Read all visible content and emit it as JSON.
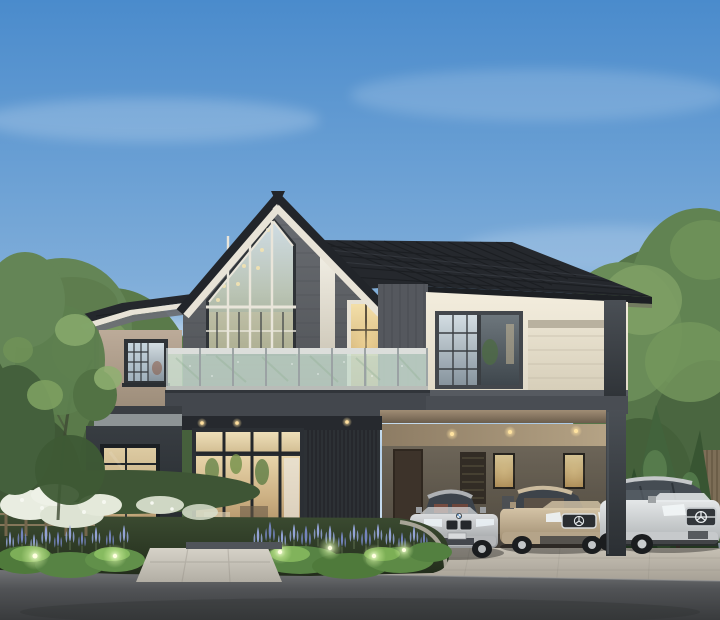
{
  "scene": {
    "description": "Dusk architectural rendering of a modern two-story house with a glazed gable facade, glass balcony, carport sheltering three cars, lavender garden beds with uplights, trees on both sides and an asphalt road in the foreground",
    "house": {
      "name": "modern-two-story-house",
      "features": [
        "dark hip roof",
        "glazed gable wall",
        "glass balcony",
        "taupe and cream walls",
        "floor-to-ceiling glass doors",
        "carport with downlights"
      ]
    },
    "cars": [
      {
        "name": "silver-bmw-sedan",
        "logo": "bmw-roundel",
        "body_color": "#c6c8ca"
      },
      {
        "name": "champagne-mercedes-sedan",
        "logo": "mercedes-star",
        "body_color": "#c0af93"
      },
      {
        "name": "white-mercedes-suv",
        "logo": "mercedes-star",
        "body_color": "#d9dcdd"
      }
    ],
    "landscaping": {
      "left": [
        "large tree",
        "white flowering shrubs",
        "low wooden fence",
        "lavender spikes",
        "trimmed shrubs",
        "garden uplights"
      ],
      "right": [
        "tall leafy trees",
        "conifers",
        "slatted fence"
      ],
      "front": [
        "concrete walkway",
        "paver driveway apron",
        "asphalt road"
      ]
    }
  },
  "colors": {
    "sky-top": "#4a8bcc",
    "sky-mid": "#7fadd9",
    "sky-low": "#b9d3ea",
    "sky-horizon": "#e3edf6",
    "roof": "#25282d",
    "roof-line": "#15171a",
    "fascia": "#e8e3d7",
    "soffit": "#6b6f74",
    "gable-wall": "#5f6267",
    "taupe": "#b4a392",
    "cream": "#efe9da",
    "trim-dark": "#3b4046",
    "band": "#43474d",
    "frame": "#2f3337",
    "glass-sky": "#c7d6e0",
    "glass-warm": "#ecd9a8",
    "balcony-glass": "#cde2d5",
    "rail": "#dcdedb",
    "carport-ceiling": "#ac9a7e",
    "carport-wall": "#7b7264",
    "door-brown": "#463b30",
    "window-glow": "#e2a95e",
    "light-warm": "#ffdf9e",
    "concrete": "#b9b3a8",
    "walkway": "#cdc9bf",
    "road": "#55575a",
    "road-dark": "#3a3c3e",
    "garden": "#32412a",
    "shrub": "#578344",
    "shrub-light": "#82b45c",
    "uplight": "#f0ffd6",
    "lavender": "#93a3d6",
    "lavender-dark": "#7484bd",
    "flower-white": "#e9ede1",
    "tree": "#5a7a4a",
    "tree-light": "#7d9c62",
    "tree-dark": "#44603a",
    "conifer": "#3f5e39",
    "car-silver": "#c6c8ca",
    "car-champagne": "#c0af93",
    "car-white": "#d9dcdd",
    "tire": "#1b1d1f"
  }
}
